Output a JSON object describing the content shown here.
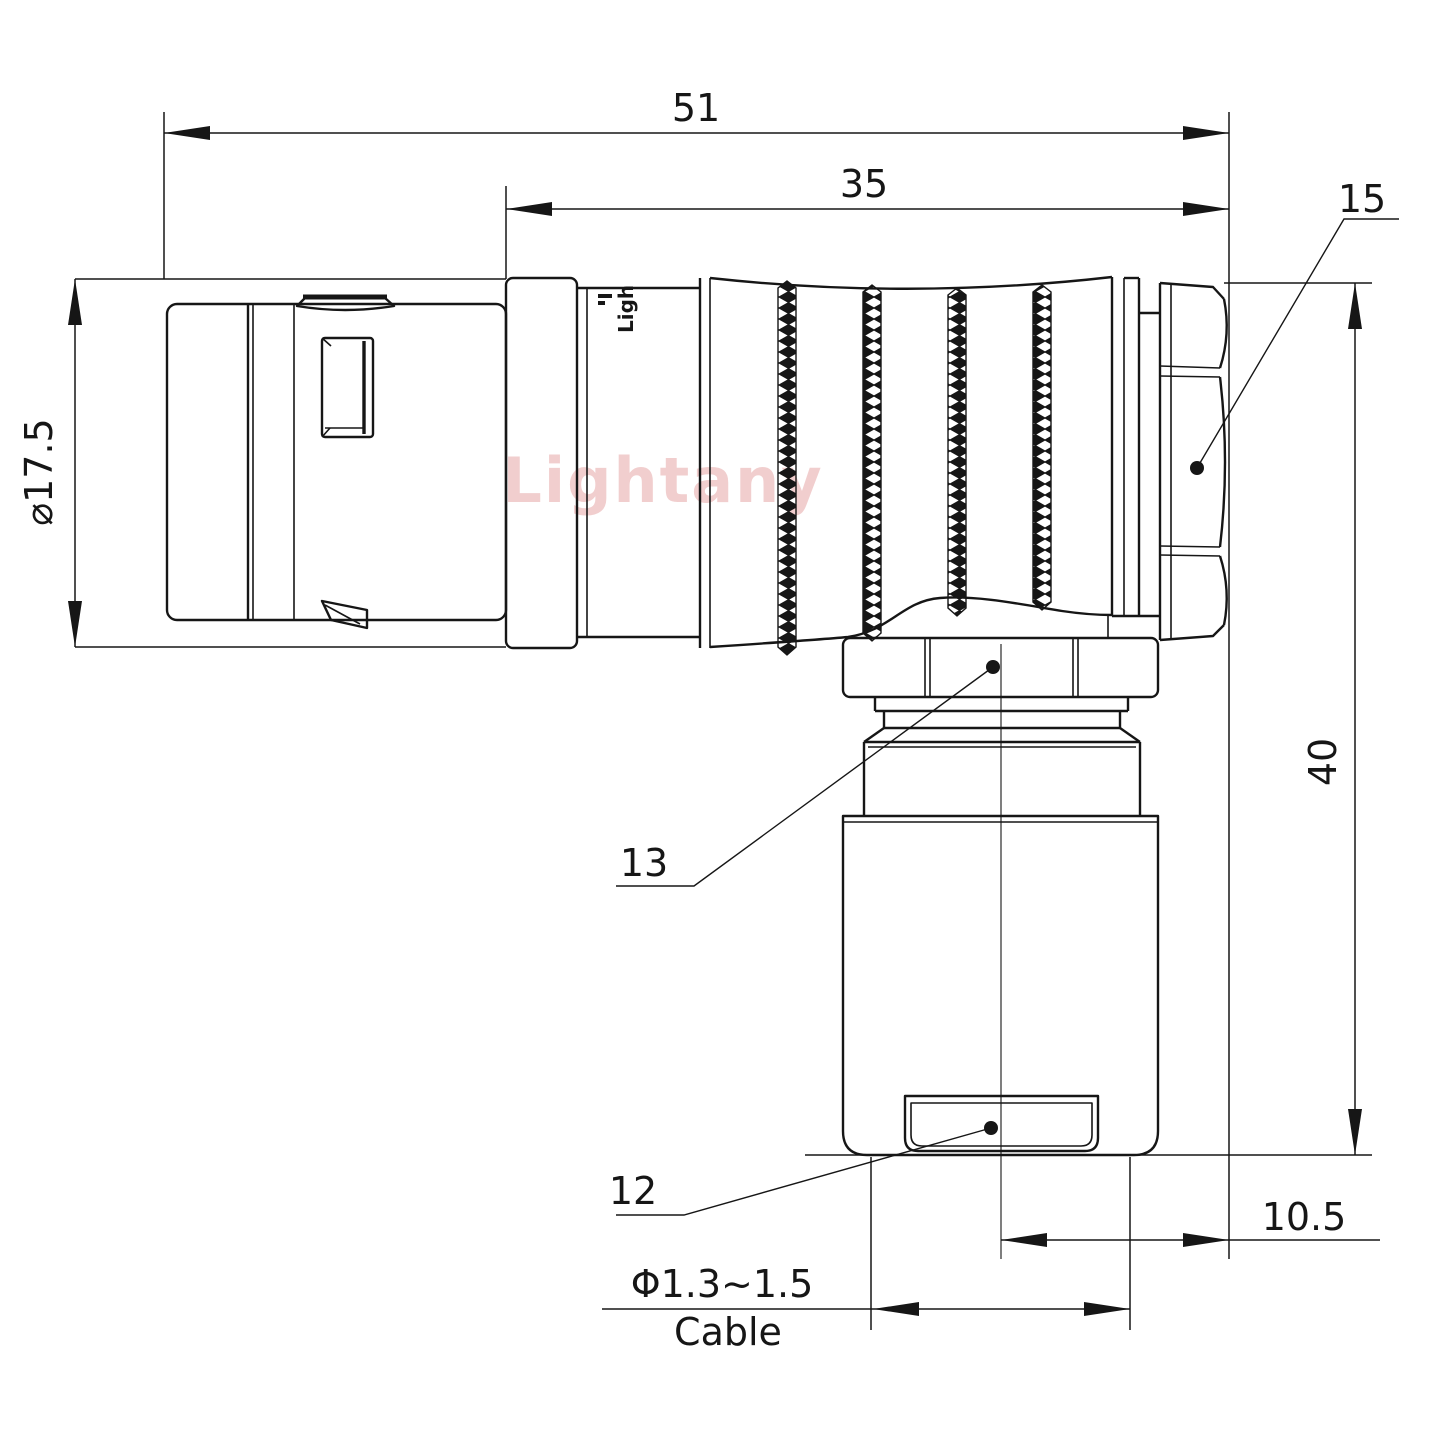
{
  "drawing": {
    "type": "technical-engineering-drawing",
    "subject": "right-angle elbow push-pull circular connector, side view",
    "background_color": "#ffffff",
    "line_color": "#161616",
    "watermark": {
      "text": "Lightany",
      "color": "#eec2c2"
    },
    "engraving": {
      "text": "Ligh"
    },
    "labels": {
      "overall_length": "51",
      "front_length": "35",
      "item_15": "15",
      "shell_diameter": "⌀17.5",
      "overall_height": "40",
      "item_13": "13",
      "item_12": "12",
      "axis_offset": "10.5",
      "cable_diameter": "Φ1.3~1.5",
      "cable_word": "Cable"
    }
  }
}
